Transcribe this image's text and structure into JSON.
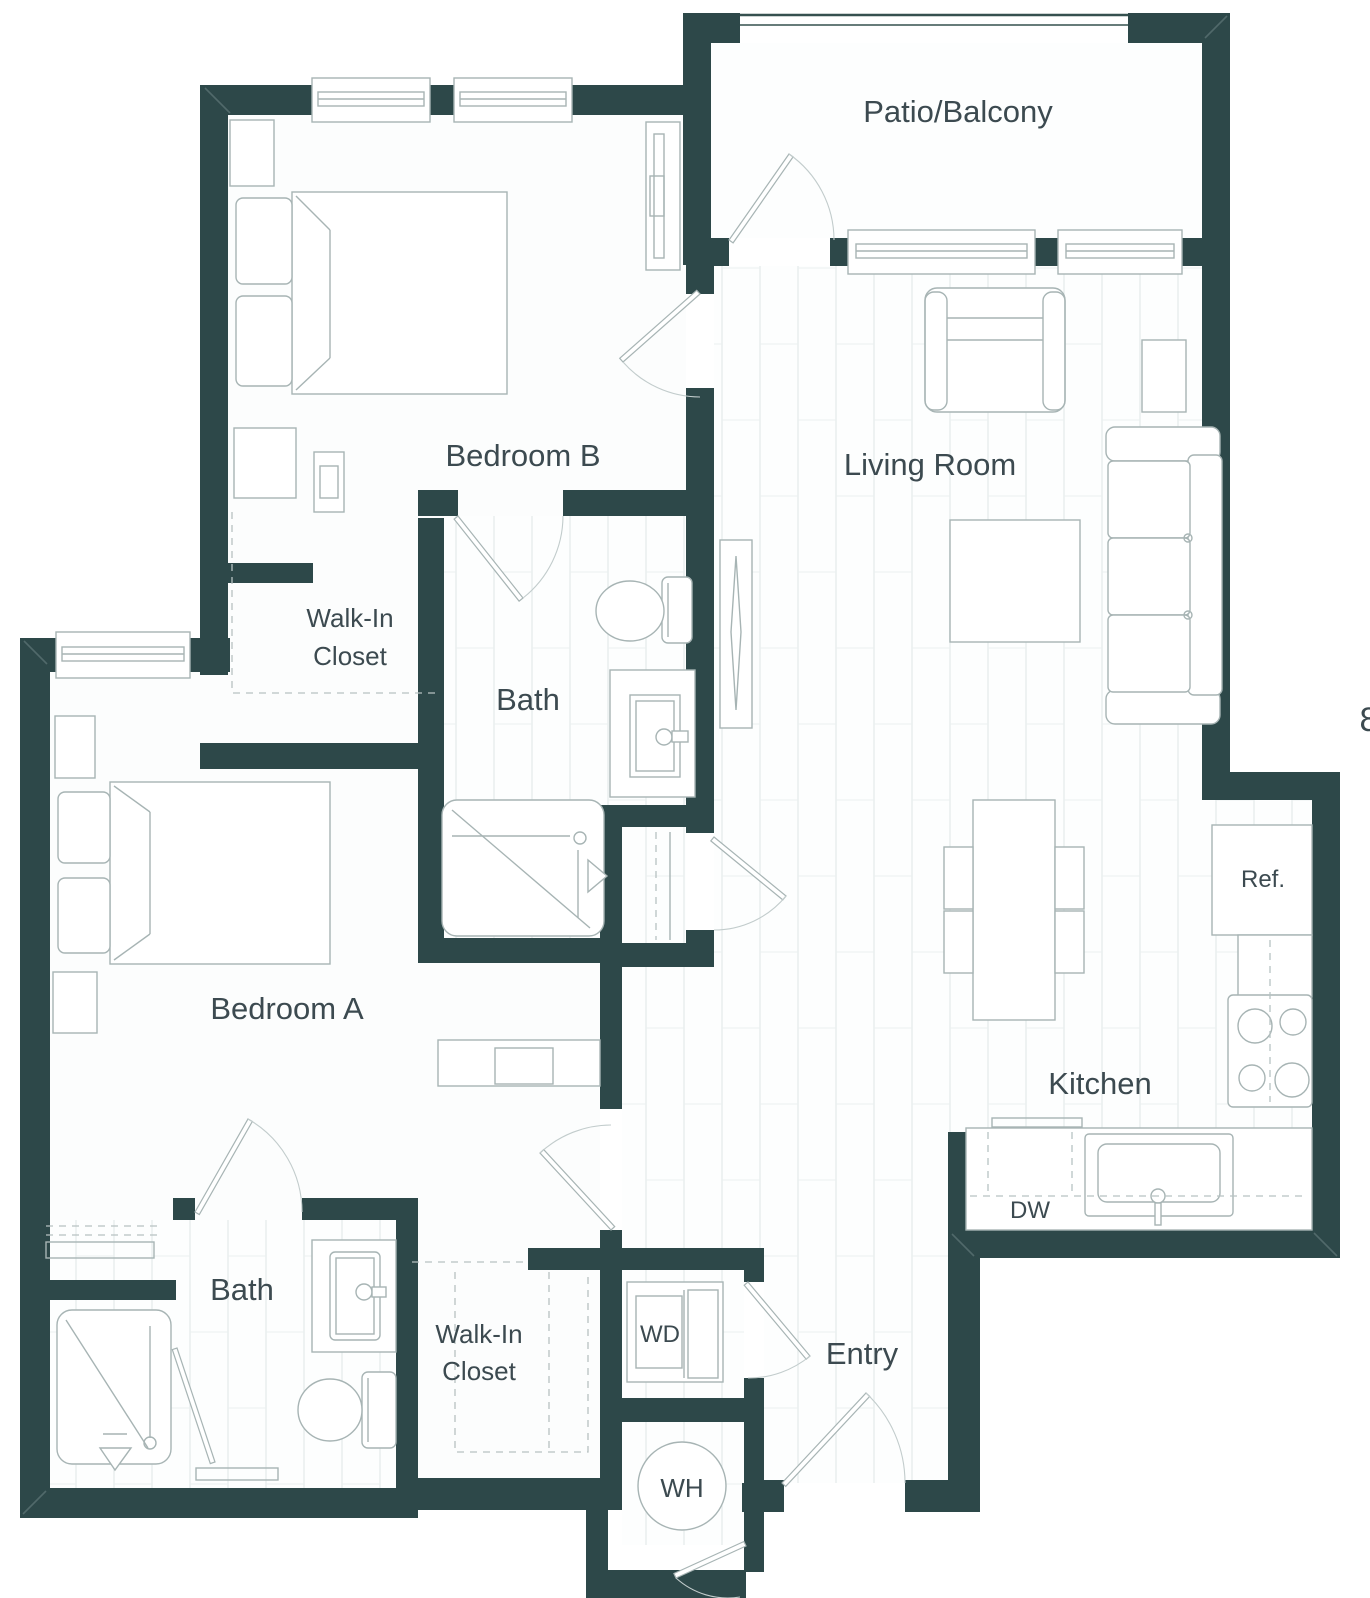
{
  "drawing_type": "apartment floor plan",
  "colors": {
    "wall": "#2d4849",
    "fixture_line": "#a7b4b4",
    "text": "#3c4a50",
    "floor": "#fcfdfd"
  },
  "rooms": {
    "patio": {
      "label": "Patio/Balcony"
    },
    "bedroom_b": {
      "label": "Bedroom B"
    },
    "living_room": {
      "label": "Living Room"
    },
    "walk_in_closet_b": {
      "line1": "Walk-In",
      "line2": "Closet"
    },
    "bath_b": {
      "label": "Bath"
    },
    "bedroom_a": {
      "label": "Bedroom A"
    },
    "kitchen": {
      "label": "Kitchen"
    },
    "bath_a": {
      "label": "Bath"
    },
    "walk_in_closet_a": {
      "line1": "Walk-In",
      "line2": "Closet"
    },
    "entry": {
      "label": "Entry"
    }
  },
  "appliances": {
    "refrigerator": "Ref.",
    "dishwasher": "DW",
    "washer_dryer": "WD",
    "water_heater": "WH"
  },
  "edge_text": {
    "partial_dimension": "8"
  }
}
